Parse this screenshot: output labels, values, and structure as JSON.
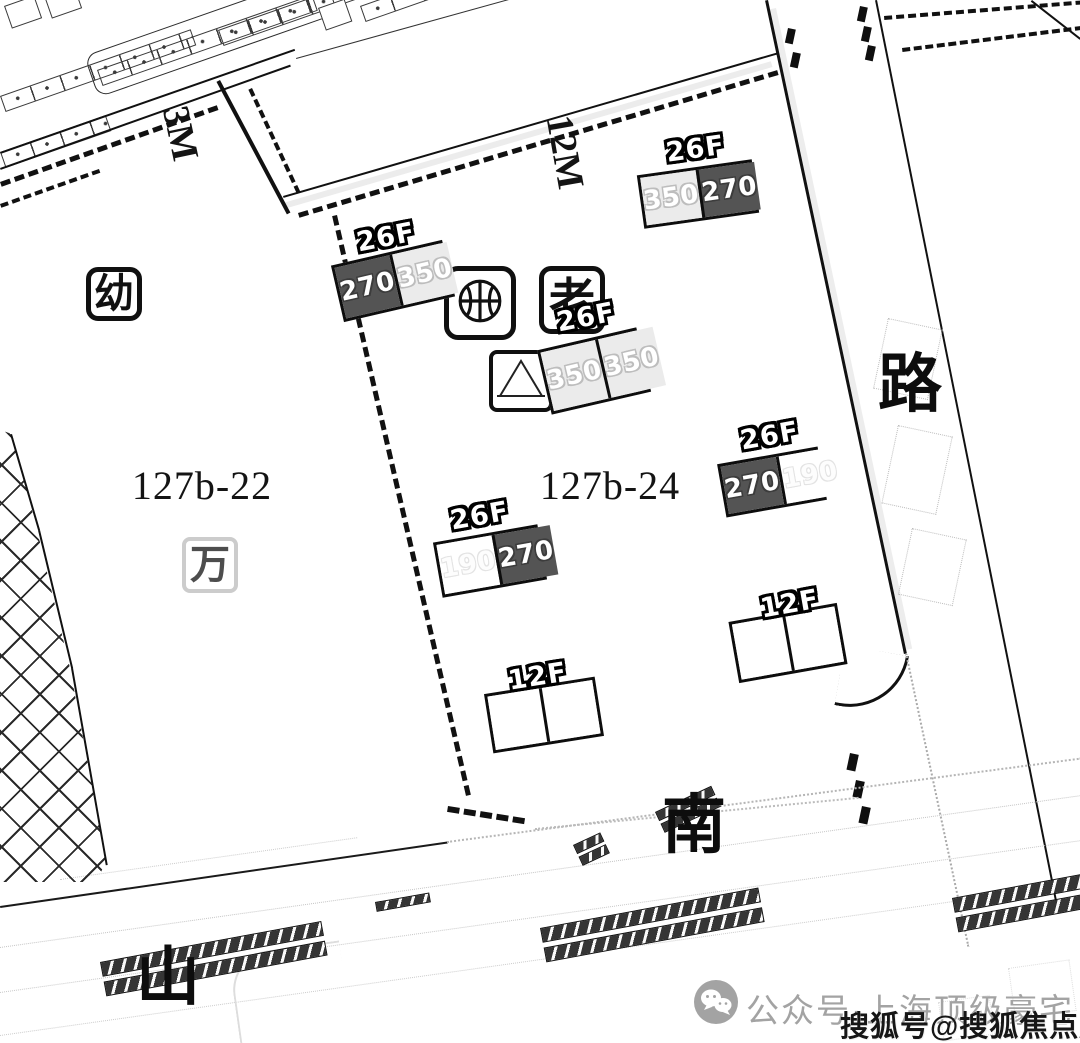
{
  "map": {
    "plot_labels": {
      "left": "127b-22",
      "center": "127b-24"
    },
    "road_labels": {
      "east": "路",
      "south": "南",
      "southwest": "山"
    },
    "dimension_labels": {
      "top_left": "3M",
      "top_center": "12M"
    },
    "facilities": {
      "kindergarten": "幼",
      "elderly": "老",
      "faded": "万"
    },
    "buildings": [
      {
        "floors": "26F",
        "cells": [
          {
            "value": "270"
          },
          {
            "value": "350"
          }
        ]
      },
      {
        "floors": "26F",
        "cells": [
          {
            "value": "350"
          },
          {
            "value": "270"
          }
        ]
      },
      {
        "floors": "26F",
        "cells": [
          {
            "value": "350"
          },
          {
            "value": "350"
          }
        ]
      },
      {
        "floors": "26F",
        "cells": [
          {
            "value": "270"
          },
          {
            "value": "190"
          }
        ]
      },
      {
        "floors": "26F",
        "cells": [
          {
            "value": "190"
          },
          {
            "value": "270"
          }
        ]
      },
      {
        "floors": "12F",
        "cells": [
          {
            "value": ""
          },
          {
            "value": ""
          }
        ]
      },
      {
        "floors": "12F",
        "cells": [
          {
            "value": ""
          },
          {
            "value": ""
          }
        ]
      }
    ]
  },
  "watermarks": {
    "wechat_account": "公众号·上海顶级豪宅",
    "sohu_account": "搜狐号@搜狐焦点庆安站"
  },
  "colors": {
    "dark_cell": "#545454",
    "light_cell": "#ebebeb",
    "line": "#111111",
    "watermark_gray": "#a3a3a3"
  }
}
